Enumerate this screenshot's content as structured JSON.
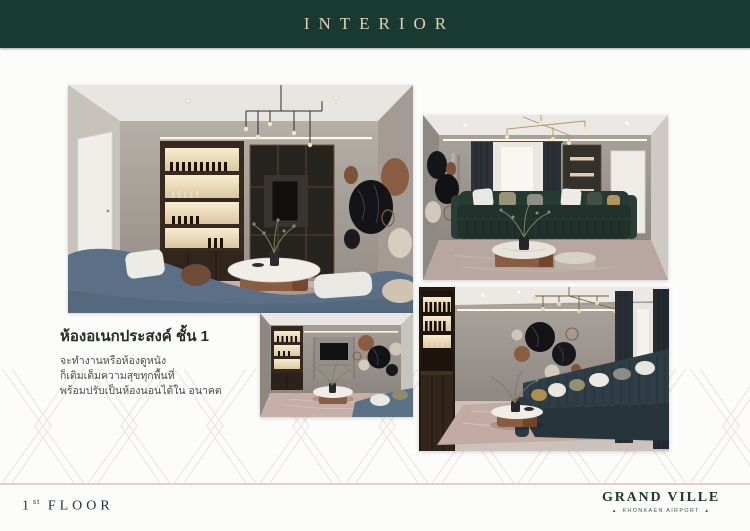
{
  "header": {
    "title": "INTERIOR"
  },
  "section": {
    "heading": "ห้องอเนกประสงค์ ชั้น 1",
    "body_lines": [
      "จะทำงานหรือห้องดูหนัง",
      "ก็เติมเต็มความสุขทุกพื้นที่",
      "พร้อมปรับเป็นห้องนอนได้ใน อนาคต"
    ]
  },
  "footer": {
    "floor_number": "1",
    "floor_ordinal": "st",
    "floor_label": "FLOOR",
    "brand_name": "GRAND VILLE",
    "brand_tagline": "KHONKAEN AIRPORT",
    "brand_ornament": "▲"
  },
  "colors": {
    "header_bg": "#183a30",
    "header_text": "#e5cfb6",
    "divider_pink": "#e9cdc5",
    "footer_text": "#20362f",
    "pattern_line": "#f0e1dc",
    "sofa_blue": "#5b7086",
    "sofa_teal": "#21322c",
    "copper": "#8a5d42"
  }
}
